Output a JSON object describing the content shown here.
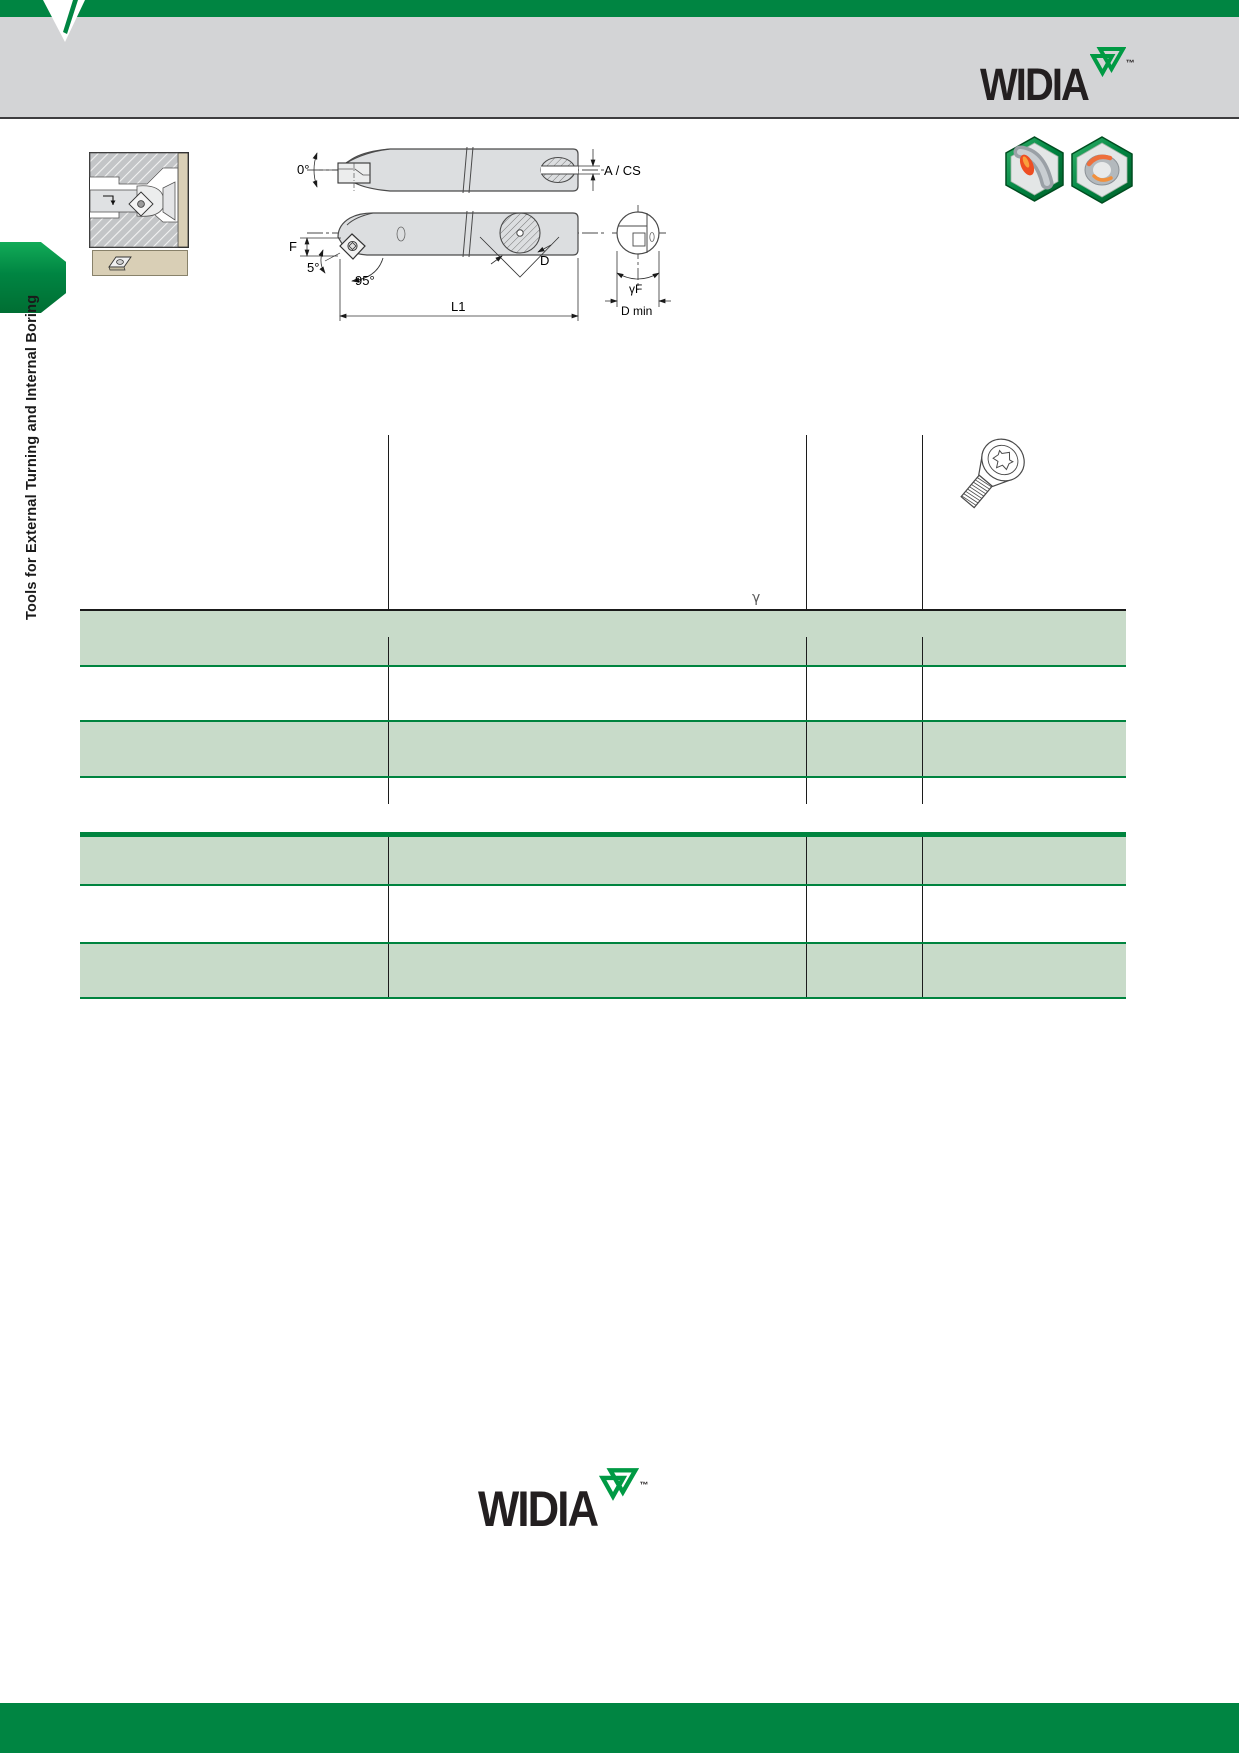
{
  "brand": {
    "name": "WIDIA",
    "tm": "™"
  },
  "sidebar": {
    "label": "Tools for External Turning and Internal Boring"
  },
  "drawings": {
    "rake_angle": "0°",
    "a_cs": "A / CS",
    "f": "F",
    "clearance": "5°",
    "lead": "95°",
    "d": "D",
    "l1": "L1",
    "gamma_f": "γF",
    "d_min": "D min"
  },
  "tables": {
    "gamma": "γ"
  },
  "footer": {
    "brand": "WIDIA",
    "tm": "™"
  },
  "icons": {
    "notch": "widia-notch-mark",
    "logo_mark": "widia-double-triangle-mark",
    "thumbnail": "boring-application-cross-section",
    "insert_box": "insert-shape-icon",
    "hex1": "turning-operation-icon",
    "hex2": "boring-operation-icon",
    "screw": "torx-countersunk-screw-icon"
  },
  "colors": {
    "brand_green": "#008542",
    "row_green": "#c8dbc9",
    "rule_green": "#00843f",
    "band_gray": "#d3d4d6",
    "tan": "#d9cfb6",
    "logo_black": "#231f20"
  }
}
